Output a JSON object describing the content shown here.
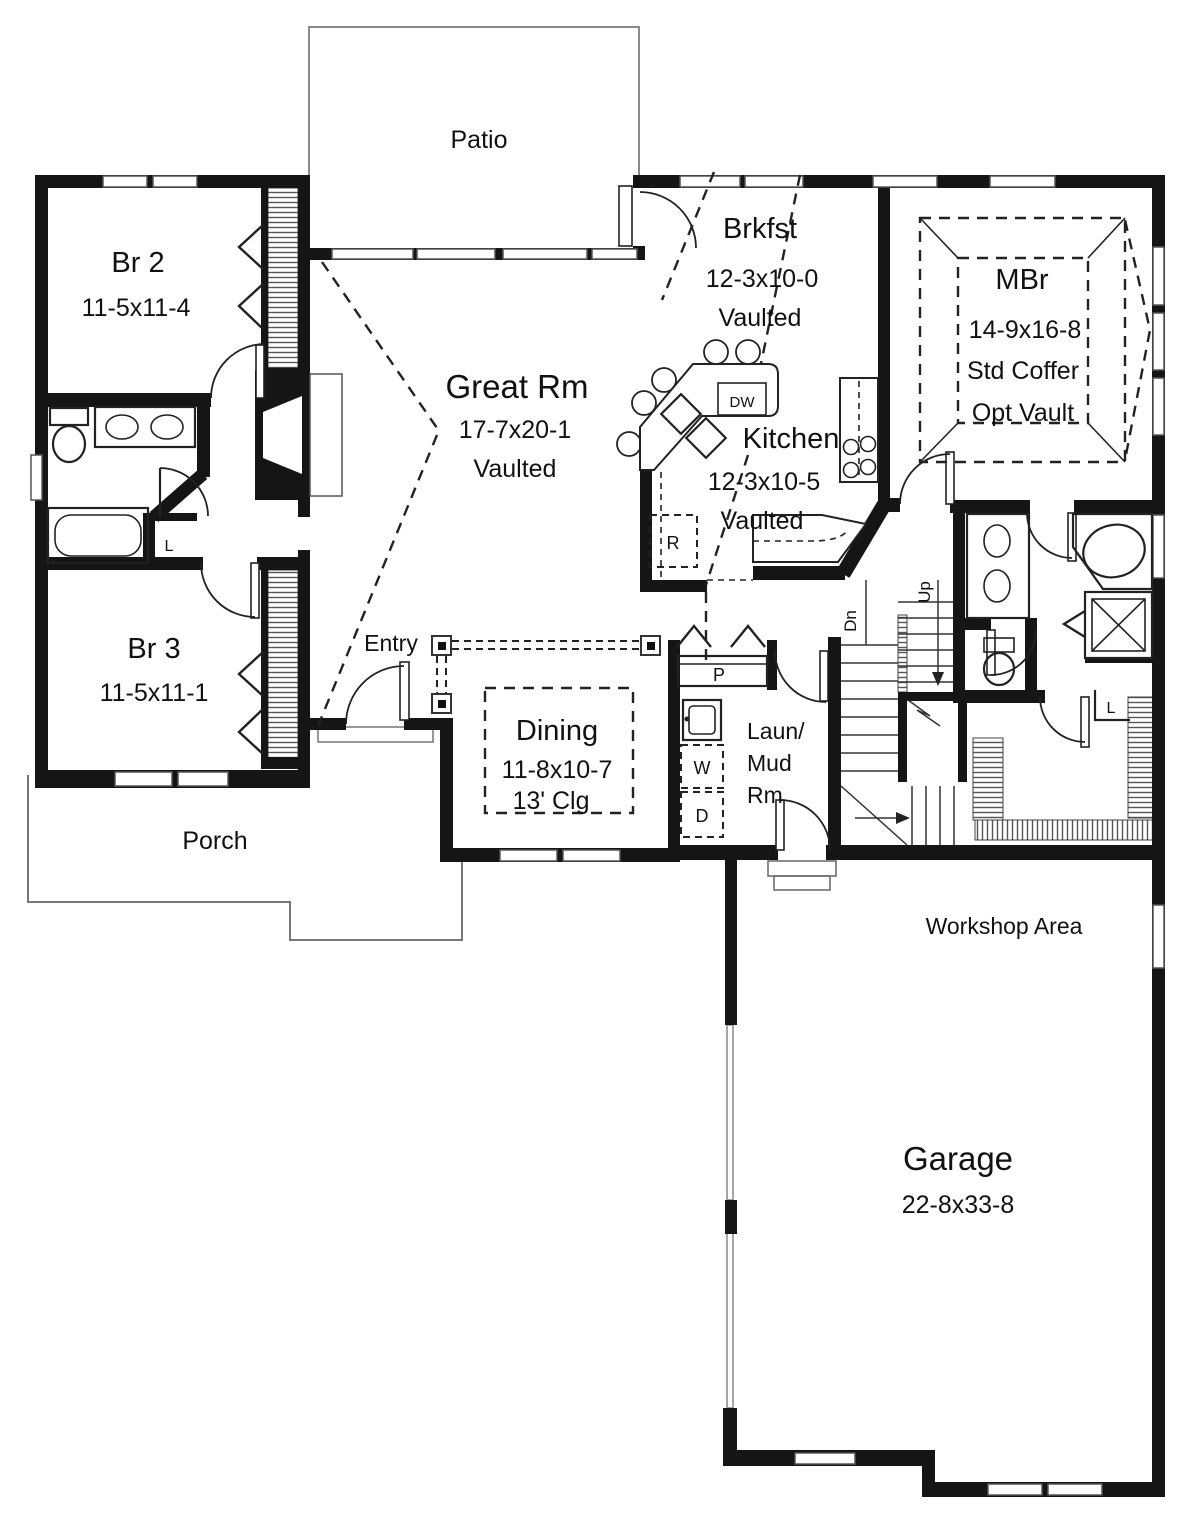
{
  "plan": {
    "rooms": {
      "patio": {
        "name": "Patio"
      },
      "br2": {
        "name": "Br 2",
        "dims": "11-5x11-4"
      },
      "great_rm": {
        "name": "Great Rm",
        "dims": "17-7x20-1",
        "ceiling": "Vaulted"
      },
      "brkfst": {
        "name": "Brkfst",
        "dims": "12-3x10-0",
        "ceiling": "Vaulted"
      },
      "mbr": {
        "name": "MBr",
        "dims": "14-9x16-8",
        "coffer": "Std Coffer",
        "vault": "Opt Vault"
      },
      "kitchen": {
        "name": "Kitchen",
        "dims": "12-3x10-5",
        "ceiling": "Vaulted"
      },
      "br3": {
        "name": "Br 3",
        "dims": "11-5x11-1"
      },
      "entry": {
        "name": "Entry"
      },
      "dining": {
        "name": "Dining",
        "dims": "11-8x10-7",
        "ceiling": "13' Clg"
      },
      "laundry": {
        "line1": "Laun/",
        "line2": "Mud",
        "line3": "Rm"
      },
      "porch": {
        "name": "Porch"
      },
      "workshop": {
        "name": "Workshop Area"
      },
      "garage": {
        "name": "Garage",
        "dims": "22-8x33-8"
      }
    },
    "tags": {
      "dishwasher": "DW",
      "refrigerator": "R",
      "pantry": "P",
      "washer": "W",
      "dryer": "D",
      "linen_bath": "L",
      "linen_wic": "L",
      "stairs_up": "Up",
      "stairs_down": "Dn"
    }
  }
}
